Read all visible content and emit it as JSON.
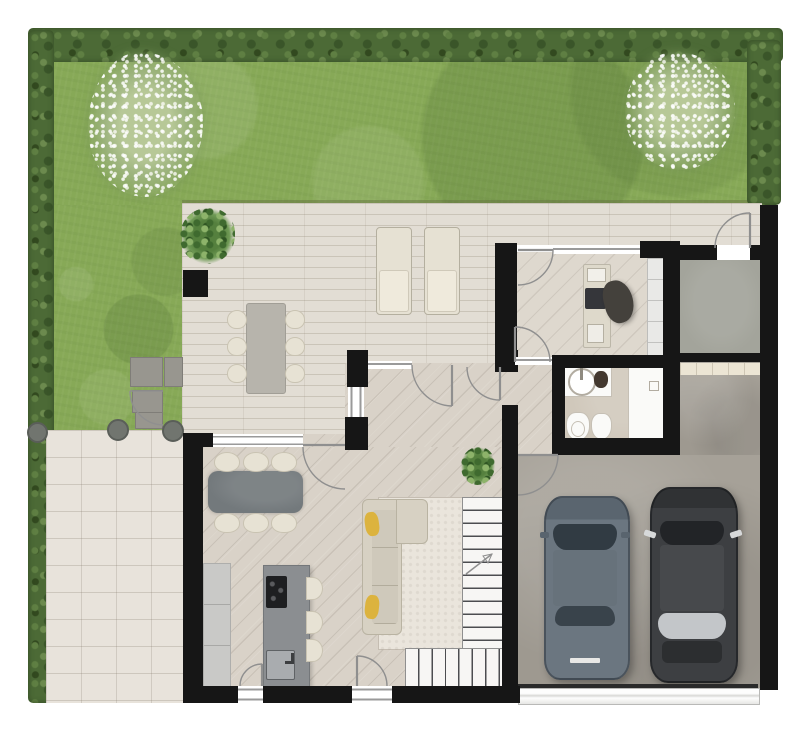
{
  "scene": {
    "type": "residential-floor-plan",
    "view": "top-down-3d-rendering",
    "level": "ground-floor"
  },
  "palette": {
    "background": "#ffffff",
    "lawn": "#87a957",
    "hedge": "#4c6a36",
    "patio": "#e2ddd4",
    "path": "#e8e3db",
    "wood": "#d9d2c8",
    "office_wood": "#ded8ce",
    "bath_floor": "#d0c8bb",
    "garage_floor": "#a6a198",
    "gray_room_floor": "#a3a49b",
    "wall": "#161616",
    "rug": "#eae5dc",
    "sofa": "#d7d1c3",
    "pillow_accent": "#dcb33e",
    "island": "#8b8e91",
    "counter": "#c9c9c7",
    "table_dark": "#73797c",
    "table_outdoor": "#b7b4ac",
    "chair_cream": "#e7e2d4",
    "stairs": "#f7f6f4",
    "car_gray": "#5f6a74",
    "car_dark": "#3a3c3f",
    "fixture_white": "#fafaf8"
  },
  "garden": {
    "hedges": 3,
    "flowering_bushes": 2,
    "stepping_stones": 4,
    "bollards": 3,
    "gate_swings": 1
  },
  "outdoor_patio": {
    "dining_seats": 6,
    "sun_loungers": 2,
    "potted_plants": 1,
    "posts": 2
  },
  "rooms": [
    {
      "name": "living-dining-kitchen",
      "furniture": [
        "dining-table-6-chairs",
        "wall-counter",
        "kitchen-island-cooktop-sink",
        "3-bar-stools",
        "sofa-2-yellow-pillows",
        "rug",
        "l-shaped-staircase"
      ]
    },
    {
      "name": "hallway",
      "furniture": [
        "floor-plant"
      ],
      "doors": 2
    },
    {
      "name": "office",
      "furniture": [
        "desk",
        "laptop",
        "task-chair",
        "side-cabinet"
      ],
      "doors": 2
    },
    {
      "name": "bathroom",
      "furniture": [
        "vanity-round-sink",
        "toilet",
        "bidet",
        "shower"
      ]
    },
    {
      "name": "storage-room",
      "furniture": [],
      "doors": 1
    },
    {
      "name": "garage",
      "furniture": [
        "shelf-strip",
        "sectional-garage-door"
      ],
      "vehicles": 2
    }
  ],
  "vehicles": [
    {
      "name": "car-gray",
      "color": "#5f6a74"
    },
    {
      "name": "car-dark",
      "color": "#3a3c3f",
      "accent": "#c3c6c9"
    }
  ]
}
